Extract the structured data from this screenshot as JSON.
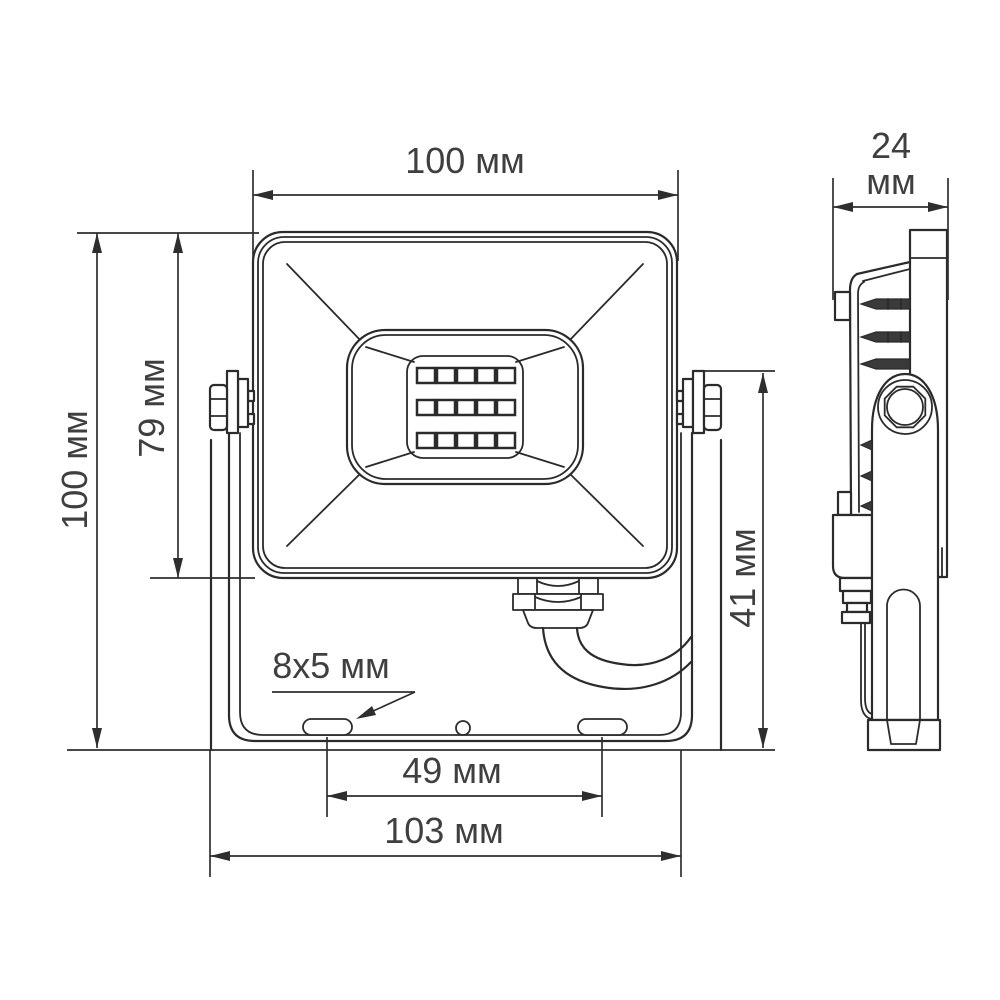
{
  "drawing": {
    "kind": "floodlight dimensional technical drawing",
    "units": "мм",
    "colors": {
      "line": "#2b2b2b",
      "text": "#3f3f3f",
      "background": "#ffffff"
    },
    "front_view": {
      "label": "front view",
      "led_grid": {
        "rows": 3,
        "columns": 5
      },
      "dimensions": {
        "top_width": {
          "label": "100 мм"
        },
        "total_height": {
          "label": "100 мм"
        },
        "body_height": {
          "label": "79 мм"
        },
        "bracket_height": {
          "label": "41 мм"
        },
        "slot_size": {
          "label": "8x5 мм"
        },
        "slot_spacing": {
          "label": "49 мм"
        },
        "overall_width": {
          "label": "103 мм"
        }
      }
    },
    "side_view": {
      "label": "side view",
      "dimensions": {
        "depth_value": "24",
        "depth_unit": "мм"
      }
    }
  }
}
